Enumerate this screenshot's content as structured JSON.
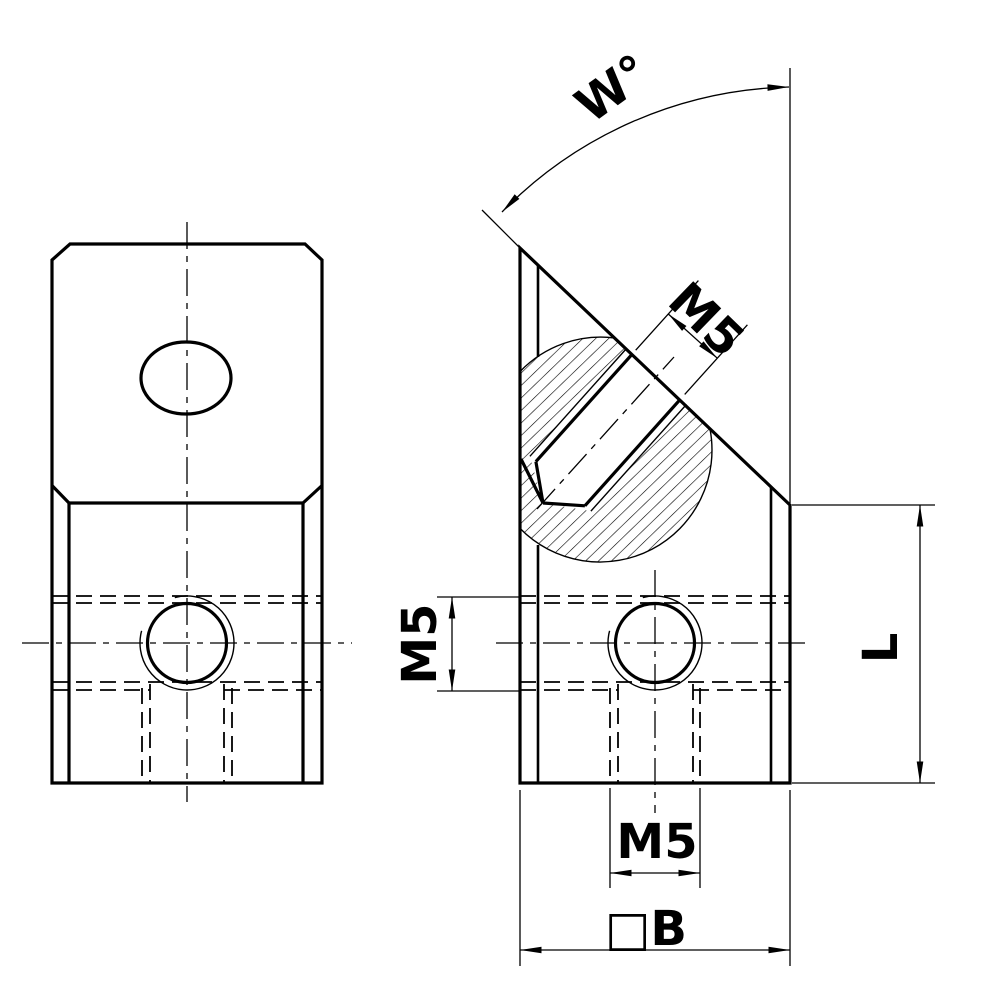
{
  "drawing": {
    "background": "#ffffff",
    "line_color": "#000000",
    "views": [
      {
        "id": "front-view"
      },
      {
        "id": "side-view"
      }
    ],
    "labels": {
      "angle": "W°",
      "thread_angled": "M5",
      "thread_side": "M5",
      "thread_bottom": "M5",
      "length": "L",
      "width": "□B"
    }
  }
}
